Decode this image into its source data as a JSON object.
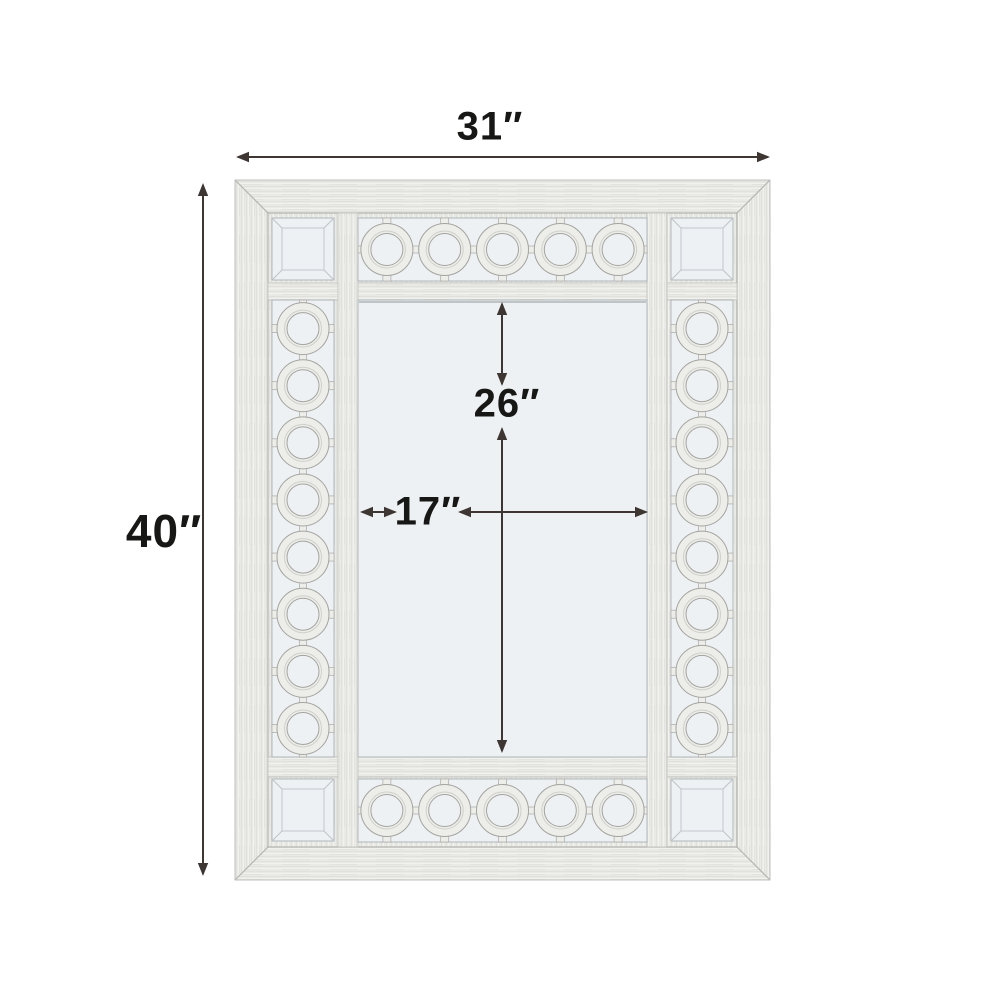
{
  "diagram": {
    "type": "product-dimension-diagram",
    "subject": "wall-mirror-with-circle-lattice-frame",
    "labels": {
      "overall_width": "31″",
      "overall_height": "40″",
      "inner_height": "26″",
      "inner_width": "17″"
    },
    "ornaments": {
      "top_count": 5,
      "bottom_count": 5,
      "left_count": 8,
      "right_count": 8
    },
    "colors": {
      "background": "#ffffff",
      "frame_base": "#e9e9e6",
      "frame_edge": "#a6a6a2",
      "miter_line": "#b4b4b0",
      "mirror_glass": "#edf1f4",
      "glass_edge": "#aab0b4",
      "ornament_fill": "#ededea",
      "ornament_edge": "#a3a39f",
      "dimension_line": "#3e3633",
      "label_text": "#171715"
    }
  }
}
